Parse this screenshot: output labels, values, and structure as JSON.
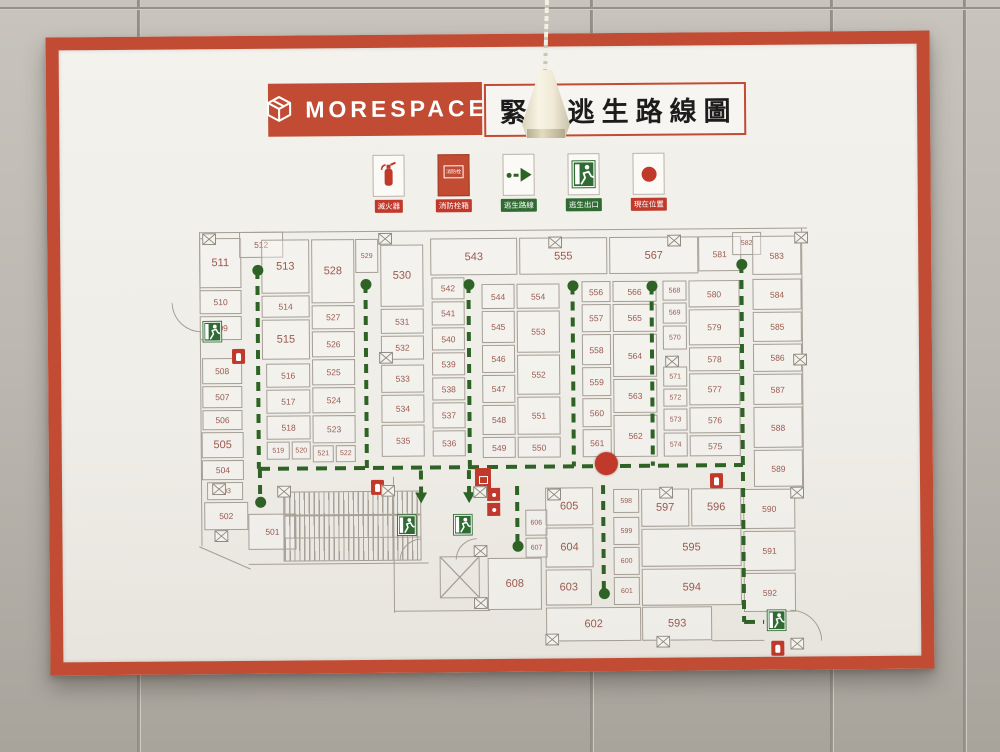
{
  "header": {
    "brand": "MORESPACE",
    "title": "緊急逃生路線圖"
  },
  "legend": [
    {
      "id": "extinguisher",
      "label": "滅火器"
    },
    {
      "id": "hydrant",
      "label": "消防栓箱",
      "icon_text": "消防栓"
    },
    {
      "id": "route",
      "label": "逃生路線"
    },
    {
      "id": "exit",
      "label": "逃生出口"
    },
    {
      "id": "position",
      "label": "現在位置"
    }
  ],
  "colors": {
    "frame_red": "#c14b33",
    "alert_red": "#c0392b",
    "route_green": "#2f6326",
    "exit_green": "#2f6b33",
    "wall_line": "#a59e95",
    "room_text": "#9a5a50"
  },
  "floorplan": {
    "rooms": [
      [
        "511",
        200,
        236,
        42,
        50,
        "lg"
      ],
      [
        "510",
        200,
        288,
        42,
        24,
        ""
      ],
      [
        "509",
        200,
        314,
        42,
        24,
        ""
      ],
      [
        "508",
        202,
        356,
        40,
        26,
        ""
      ],
      [
        "507",
        202,
        384,
        40,
        22,
        ""
      ],
      [
        "506",
        202,
        408,
        40,
        20,
        ""
      ],
      [
        "505",
        201,
        430,
        42,
        26,
        "lg"
      ],
      [
        "504",
        201,
        458,
        42,
        20,
        ""
      ],
      [
        "503",
        206,
        480,
        36,
        18,
        "sm"
      ],
      [
        "502",
        203,
        500,
        44,
        28,
        ""
      ],
      [
        "501",
        247,
        512,
        48,
        36,
        ""
      ],
      [
        "512",
        240,
        230,
        44,
        26,
        ""
      ],
      [
        "513",
        262,
        238,
        48,
        54,
        "lg"
      ],
      [
        "514",
        262,
        294,
        48,
        22,
        ""
      ],
      [
        "515",
        262,
        318,
        48,
        40,
        "lg"
      ],
      [
        "516",
        266,
        362,
        44,
        24,
        ""
      ],
      [
        "517",
        266,
        388,
        44,
        24,
        ""
      ],
      [
        "518",
        266,
        414,
        44,
        24,
        ""
      ],
      [
        "519",
        266,
        440,
        23,
        18,
        "sm"
      ],
      [
        "520",
        291,
        440,
        19,
        18,
        "sm"
      ],
      [
        "521",
        312,
        444,
        21,
        17,
        "sm"
      ],
      [
        "522",
        335,
        444,
        20,
        17,
        "sm"
      ],
      [
        "523",
        312,
        414,
        43,
        28,
        ""
      ],
      [
        "524",
        312,
        386,
        43,
        26,
        ""
      ],
      [
        "525",
        312,
        358,
        43,
        26,
        ""
      ],
      [
        "526",
        312,
        330,
        43,
        26,
        ""
      ],
      [
        "527",
        312,
        304,
        43,
        24,
        ""
      ],
      [
        "528",
        312,
        238,
        43,
        64,
        "lg"
      ],
      [
        "529",
        356,
        238,
        23,
        34,
        "sm"
      ],
      [
        "530",
        381,
        244,
        43,
        62,
        "lg"
      ],
      [
        "531",
        381,
        308,
        43,
        25,
        ""
      ],
      [
        "532",
        381,
        335,
        43,
        24,
        ""
      ],
      [
        "533",
        381,
        364,
        43,
        28,
        ""
      ],
      [
        "534",
        381,
        394,
        43,
        28,
        ""
      ],
      [
        "535",
        381,
        424,
        43,
        32,
        ""
      ],
      [
        "542",
        432,
        277,
        33,
        22,
        ""
      ],
      [
        "541",
        432,
        301,
        33,
        24,
        ""
      ],
      [
        "540",
        432,
        327,
        33,
        23,
        ""
      ],
      [
        "539",
        432,
        352,
        33,
        23,
        ""
      ],
      [
        "538",
        432,
        377,
        33,
        23,
        ""
      ],
      [
        "537",
        432,
        402,
        33,
        26,
        ""
      ],
      [
        "536",
        432,
        430,
        33,
        26,
        ""
      ],
      [
        "543",
        431,
        238,
        87,
        37,
        "lg"
      ],
      [
        "544",
        482,
        284,
        33,
        25,
        ""
      ],
      [
        "545",
        482,
        311,
        33,
        32,
        ""
      ],
      [
        "546",
        482,
        345,
        33,
        28,
        ""
      ],
      [
        "547",
        482,
        375,
        33,
        28,
        ""
      ],
      [
        "548",
        482,
        405,
        33,
        30,
        ""
      ],
      [
        "549",
        482,
        437,
        33,
        21,
        ""
      ],
      [
        "554",
        517,
        284,
        43,
        25,
        ""
      ],
      [
        "553",
        517,
        311,
        43,
        42,
        ""
      ],
      [
        "552",
        517,
        355,
        43,
        40,
        ""
      ],
      [
        "551",
        517,
        397,
        43,
        38,
        ""
      ],
      [
        "550",
        517,
        437,
        43,
        21,
        ""
      ],
      [
        "555",
        520,
        238,
        88,
        37,
        "lg"
      ],
      [
        "556",
        582,
        282,
        29,
        21,
        ""
      ],
      [
        "557",
        582,
        305,
        29,
        28,
        ""
      ],
      [
        "558",
        582,
        335,
        29,
        31,
        ""
      ],
      [
        "559",
        582,
        368,
        29,
        29,
        ""
      ],
      [
        "560",
        582,
        399,
        29,
        29,
        ""
      ],
      [
        "561",
        582,
        430,
        29,
        28,
        ""
      ],
      [
        "566",
        613,
        282,
        44,
        21,
        ""
      ],
      [
        "565",
        613,
        305,
        44,
        28,
        ""
      ],
      [
        "564",
        613,
        335,
        44,
        43,
        ""
      ],
      [
        "563",
        613,
        380,
        44,
        34,
        ""
      ],
      [
        "562",
        613,
        416,
        44,
        42,
        ""
      ],
      [
        "567",
        610,
        238,
        89,
        37,
        "lg"
      ],
      [
        "568",
        663,
        282,
        24,
        20,
        "sm"
      ],
      [
        "569",
        663,
        304,
        24,
        21,
        "sm"
      ],
      [
        "570",
        663,
        327,
        24,
        24,
        "sm"
      ],
      [
        "571",
        663,
        368,
        24,
        20,
        "sm"
      ],
      [
        "572",
        663,
        390,
        24,
        18,
        "sm"
      ],
      [
        "573",
        663,
        410,
        24,
        22,
        "sm"
      ],
      [
        "574",
        663,
        434,
        24,
        24,
        "sm"
      ],
      [
        "580",
        689,
        282,
        51,
        27,
        ""
      ],
      [
        "579",
        689,
        311,
        51,
        36,
        ""
      ],
      [
        "578",
        689,
        349,
        51,
        24,
        ""
      ],
      [
        "577",
        689,
        375,
        51,
        32,
        ""
      ],
      [
        "576",
        689,
        409,
        51,
        26,
        ""
      ],
      [
        "575",
        689,
        437,
        51,
        21,
        ""
      ],
      [
        "581",
        699,
        238,
        43,
        35,
        ""
      ],
      [
        "582",
        733,
        234,
        29,
        23,
        "sm"
      ],
      [
        "583",
        753,
        238,
        49,
        39,
        ""
      ],
      [
        "584",
        753,
        281,
        49,
        31,
        ""
      ],
      [
        "585",
        753,
        314,
        49,
        30,
        ""
      ],
      [
        "586",
        753,
        346,
        49,
        28,
        ""
      ],
      [
        "587",
        753,
        376,
        49,
        31,
        ""
      ],
      [
        "588",
        753,
        409,
        49,
        41,
        ""
      ],
      [
        "589",
        753,
        452,
        49,
        37,
        ""
      ],
      [
        "590",
        742,
        491,
        52,
        40,
        ""
      ],
      [
        "591",
        742,
        533,
        52,
        40,
        ""
      ],
      [
        "592",
        742,
        575,
        52,
        39,
        ""
      ],
      [
        "605",
        544,
        488,
        48,
        38,
        "lg"
      ],
      [
        "604",
        544,
        528,
        48,
        40,
        "lg"
      ],
      [
        "603",
        544,
        570,
        46,
        36,
        "lg"
      ],
      [
        "606",
        524,
        510,
        22,
        26,
        "sm"
      ],
      [
        "607",
        524,
        538,
        22,
        20,
        "sm"
      ],
      [
        "608",
        486,
        558,
        54,
        52,
        "lg"
      ],
      [
        "598",
        612,
        490,
        26,
        24,
        "sm"
      ],
      [
        "599",
        612,
        518,
        26,
        28,
        "sm"
      ],
      [
        "600",
        612,
        548,
        26,
        28,
        "sm"
      ],
      [
        "601",
        612,
        578,
        26,
        28,
        "sm"
      ],
      [
        "597",
        640,
        490,
        48,
        38,
        "lg"
      ],
      [
        "596",
        690,
        490,
        50,
        38,
        "lg"
      ],
      [
        "595",
        640,
        530,
        100,
        38,
        "lg"
      ],
      [
        "594",
        640,
        570,
        100,
        37,
        "lg"
      ],
      [
        "602",
        544,
        608,
        95,
        34,
        "lg"
      ],
      [
        "593",
        640,
        608,
        70,
        34,
        "lg"
      ]
    ],
    "walls": [
      [
        "h",
        200,
        230,
        608
      ],
      [
        "v",
        200,
        230,
        68
      ],
      [
        "v",
        200,
        330,
        214
      ],
      [
        "h",
        247,
        562,
        180
      ],
      [
        "v",
        392,
        476,
        136
      ],
      [
        "h",
        392,
        610,
        96
      ],
      [
        "v",
        802,
        230,
        262
      ],
      [
        "h",
        710,
        642,
        52
      ],
      [
        "diag",
        198,
        544,
        56,
        24
      ]
    ],
    "arcs": [
      {
        "x": 172,
        "y": 300,
        "r": 30,
        "c": "bl"
      },
      {
        "x": 398,
        "y": 538,
        "r": 22,
        "c": "tl"
      },
      {
        "x": 454,
        "y": 538,
        "r": 22,
        "c": "tl"
      },
      {
        "x": 788,
        "y": 612,
        "r": 32,
        "c": "tr"
      }
    ],
    "stairs": {
      "x": 282,
      "y": 490,
      "w": 138,
      "h": 70
    },
    "elevator": {
      "x": 438,
      "y": 556,
      "w": 40,
      "h": 42
    },
    "route_segments": [
      [
        258,
        268,
        258,
        467,
        "dot",
        ""
      ],
      [
        259,
        467,
        259,
        500,
        "",
        "dot"
      ],
      [
        366,
        283,
        366,
        467,
        "dot",
        ""
      ],
      [
        469,
        284,
        469,
        467,
        "dot",
        ""
      ],
      [
        573,
        286,
        573,
        467,
        "dot",
        ""
      ],
      [
        652,
        287,
        652,
        467,
        "dot",
        ""
      ],
      [
        258,
        467,
        742,
        467,
        "",
        ""
      ],
      [
        742,
        266,
        742,
        624,
        "dot",
        ""
      ],
      [
        742,
        624,
        762,
        624,
        "",
        ""
      ],
      [
        602,
        486,
        602,
        594,
        "",
        "dot"
      ],
      [
        516,
        486,
        516,
        546,
        "",
        "dot"
      ],
      [
        420,
        470,
        420,
        494,
        "",
        "arrow"
      ],
      [
        468,
        470,
        468,
        494,
        "",
        "arrow"
      ]
    ],
    "icons": {
      "exits": [
        [
          202,
          318
        ],
        [
          395,
          513
        ],
        [
          451,
          513
        ],
        [
          764,
          611
        ]
      ],
      "extinguishers": [
        [
          232,
          347
        ],
        [
          370,
          479
        ],
        [
          709,
          475
        ],
        [
          769,
          643
        ]
      ],
      "hydrants": [
        [
          474,
          468
        ]
      ],
      "alarms": [
        [
          486,
          488
        ],
        [
          486,
          503
        ]
      ],
      "service_boxes": [
        [
          203,
          231
        ],
        [
          379,
          232
        ],
        [
          549,
          237
        ],
        [
          668,
          236
        ],
        [
          795,
          234
        ],
        [
          379,
          351
        ],
        [
          665,
          357
        ],
        [
          793,
          356
        ],
        [
          211,
          481
        ],
        [
          213,
          528
        ],
        [
          276,
          484
        ],
        [
          380,
          484
        ],
        [
          472,
          486
        ],
        [
          472,
          545
        ],
        [
          472,
          597
        ],
        [
          546,
          489
        ],
        [
          658,
          488
        ],
        [
          789,
          489
        ],
        [
          543,
          634
        ],
        [
          654,
          637
        ],
        [
          788,
          640
        ]
      ]
    },
    "current_position": {
      "x": 605,
      "y": 464
    }
  }
}
